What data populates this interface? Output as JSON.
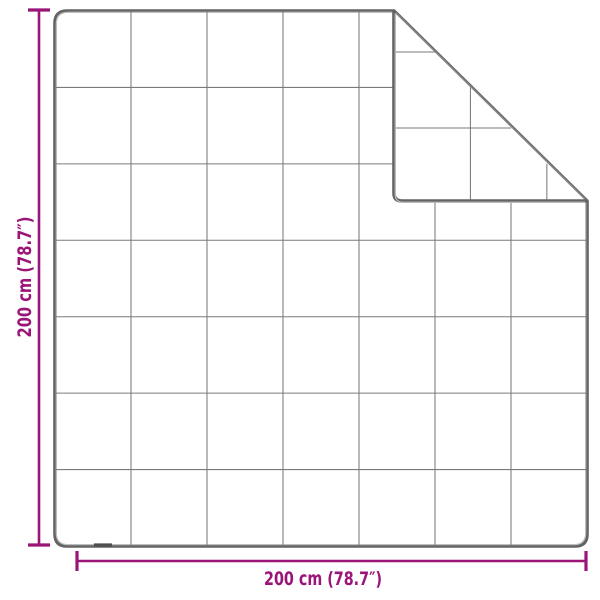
{
  "diagram": {
    "subject": "Blanket with quilted square grid and folded-back top-right corner",
    "grid": {
      "rows": 7,
      "cols": 7
    },
    "dimensions": {
      "width_label": "200 cm (78.7″)",
      "height_label": "200 cm (78.7″)"
    },
    "colors": {
      "dimension_accent": "#9b1578",
      "outline": "#646464",
      "outline_highlight": "#c0c0c0",
      "grid_line": "#7a7a7a",
      "fold_edge": "#868686",
      "background": "#ffffff"
    }
  }
}
